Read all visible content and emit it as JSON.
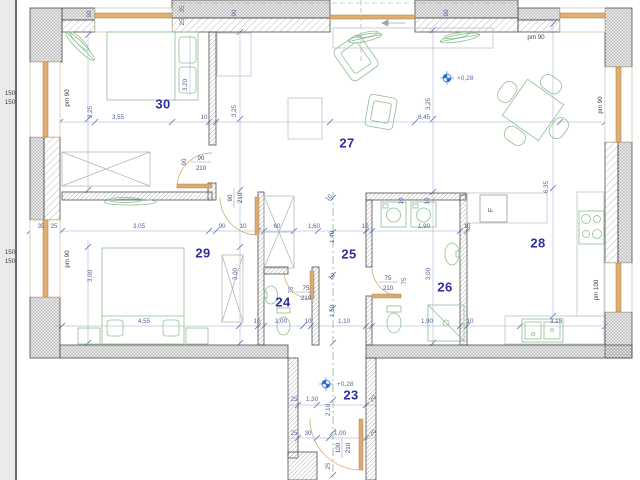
{
  "colors": {
    "wall_line": "#4d4d4d",
    "window_orange": "#dfae74",
    "furniture_green": "#8fbf92",
    "dimension_text": "#55609b",
    "room_number_text": "#2e2e9d",
    "level_marker_blue": "#2f6fce"
  },
  "rooms": [
    {
      "n": "30"
    },
    {
      "n": "27"
    },
    {
      "n": "28"
    },
    {
      "n": "29"
    },
    {
      "n": "25"
    },
    {
      "n": "24"
    },
    {
      "n": "26"
    },
    {
      "n": "23"
    }
  ],
  "dimensions": [
    {
      "t": "3,55",
      "x": 118,
      "y": 119
    },
    {
      "t": "10",
      "x": 204,
      "y": 119
    },
    {
      "t": "8,45",
      "x": 424,
      "y": 119
    },
    {
      "t": "90",
      "x": 91,
      "y": 14,
      "r": -90
    },
    {
      "t": "35",
      "x": 184,
      "y": 9,
      "r": -90
    },
    {
      "t": "25",
      "x": 184,
      "y": 22,
      "r": -90
    },
    {
      "t": "90",
      "x": 236,
      "y": 13,
      "r": -90
    },
    {
      "t": "90",
      "x": 448,
      "y": 13,
      "r": -90
    },
    {
      "t": "3,25",
      "x": 92,
      "y": 112,
      "r": -90
    },
    {
      "t": "3,20",
      "x": 187,
      "y": 85,
      "r": -90
    },
    {
      "t": "3,25",
      "x": 236,
      "y": 111,
      "r": -90
    },
    {
      "t": "3,25",
      "x": 430,
      "y": 104,
      "r": -90
    },
    {
      "t": "6,35",
      "x": 548,
      "y": 187,
      "r": -90
    },
    {
      "t": "35",
      "x": 41,
      "y": 228
    },
    {
      "t": "25",
      "x": 54,
      "y": 228
    },
    {
      "t": "3,05",
      "x": 139,
      "y": 228
    },
    {
      "t": "90",
      "x": 222,
      "y": 228
    },
    {
      "t": "10",
      "x": 243,
      "y": 228
    },
    {
      "t": "60",
      "x": 277,
      "y": 228
    },
    {
      "t": "1,60",
      "x": 314,
      "y": 228
    },
    {
      "t": "10",
      "x": 365,
      "y": 228
    },
    {
      "t": "1,90",
      "x": 424,
      "y": 228
    },
    {
      "t": "10",
      "x": 467,
      "y": 228
    },
    {
      "t": "1,40",
      "x": 334,
      "y": 237,
      "r": -90
    },
    {
      "t": "1,50",
      "x": 334,
      "y": 311,
      "r": -90
    },
    {
      "t": "3,00",
      "x": 92,
      "y": 276,
      "r": -90
    },
    {
      "t": "3,00",
      "x": 237,
      "y": 274,
      "r": -90
    },
    {
      "t": "3,00",
      "x": 430,
      "y": 274,
      "r": -90
    },
    {
      "t": "10",
      "x": 330,
      "y": 199,
      "r": -45
    },
    {
      "t": "10",
      "x": 333,
      "y": 278,
      "r": -45
    },
    {
      "t": "10",
      "x": 403,
      "y": 201,
      "r": -90
    },
    {
      "t": "10",
      "x": 429,
      "y": 201,
      "r": -90
    },
    {
      "t": "4,55",
      "x": 144,
      "y": 323
    },
    {
      "t": "10",
      "x": 257,
      "y": 323
    },
    {
      "t": "1,00",
      "x": 281,
      "y": 323
    },
    {
      "t": "10",
      "x": 308,
      "y": 323
    },
    {
      "t": "1,10",
      "x": 344,
      "y": 323
    },
    {
      "t": "1,90",
      "x": 427,
      "y": 323
    },
    {
      "t": "10",
      "x": 470,
      "y": 323
    },
    {
      "t": "3,15",
      "x": 556,
      "y": 323
    },
    {
      "t": "25",
      "x": 294,
      "y": 401
    },
    {
      "t": "1,30",
      "x": 312,
      "y": 401
    },
    {
      "t": "20",
      "x": 374,
      "y": 400,
      "r": -45
    },
    {
      "t": "2,10",
      "x": 330,
      "y": 410,
      "r": -90
    },
    {
      "t": "25",
      "x": 294,
      "y": 435
    },
    {
      "t": "30",
      "x": 308,
      "y": 435
    },
    {
      "t": "1,00",
      "x": 340,
      "y": 435
    },
    {
      "t": "20",
      "x": 374,
      "y": 434,
      "r": -45
    },
    {
      "t": "25",
      "x": 330,
      "y": 466,
      "r": -90
    },
    {
      "t": "90",
      "x": 186,
      "y": 162,
      "r": -90
    },
    {
      "t": "75",
      "x": 293,
      "y": 290,
      "r": -90
    },
    {
      "t": "75",
      "x": 406,
      "y": 281,
      "r": -90
    }
  ],
  "window_labels": [
    {
      "t": "pm 90",
      "x": 536,
      "y": 39
    },
    {
      "t": "pm 90",
      "x": 69,
      "y": 98,
      "r": -90
    },
    {
      "t": "pm 90",
      "x": 69,
      "y": 259,
      "r": -90
    },
    {
      "t": "pm 90",
      "x": 602,
      "y": 105,
      "r": -90
    },
    {
      "t": "pm 100",
      "x": 598,
      "y": 290,
      "r": -90
    },
    {
      "t": "150",
      "x": 10,
      "y": 95
    },
    {
      "t": "150",
      "x": 10,
      "y": 104
    },
    {
      "t": "150",
      "x": 10,
      "y": 254
    },
    {
      "t": "150",
      "x": 10,
      "y": 263
    }
  ],
  "door_labels": [
    {
      "w": "90",
      "h": "210",
      "x": 191,
      "y": 162,
      "r": 0
    },
    {
      "w": "90",
      "h": "210",
      "x": 234,
      "y": 208,
      "r": -90
    },
    {
      "w": "75",
      "h": "210",
      "x": 296,
      "y": 292,
      "r": 0
    },
    {
      "w": "75",
      "h": "210",
      "x": 378,
      "y": 282,
      "r": 0
    },
    {
      "w": "100",
      "h": "210",
      "x": 342,
      "y": 458,
      "r": -90
    }
  ],
  "level_markers": [
    {
      "t": "+0,28",
      "x": 457,
      "y": 80,
      "sx": 447,
      "sy": 78
    },
    {
      "t": "+0,28",
      "x": 337,
      "y": 386,
      "sx": 326,
      "sy": 384
    }
  ],
  "misc_labels": [
    {
      "t": "F",
      "x": 493,
      "y": 210,
      "r": -90
    }
  ]
}
